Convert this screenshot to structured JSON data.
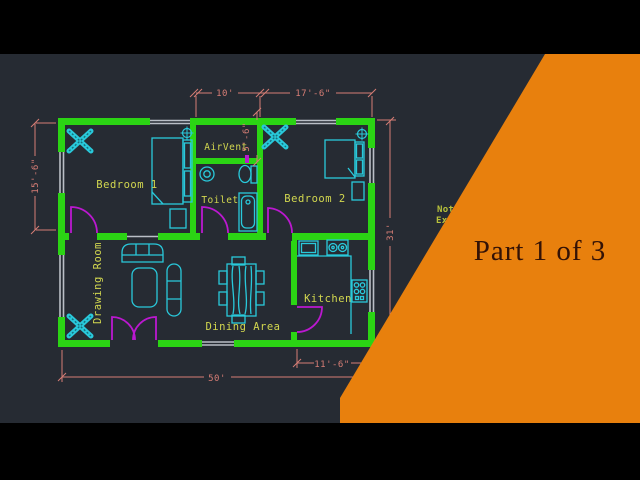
{
  "overlay": {
    "title": "Part 1 of 3",
    "note_line1": "Not",
    "note_line2": "Ex",
    "banner_color": "#e8800d",
    "title_color": "#331206"
  },
  "floor_plan": {
    "room_labels": {
      "bedroom1": "Bedroom 1",
      "bedroom2": "Bedroom 2",
      "airvent": "AirVent",
      "toilet": "Toilet",
      "drawing_room": "Drawing Room",
      "dining_area": "Dining Area",
      "kitchen": "Kitchen"
    },
    "dimensions": {
      "airvent_width": "10'",
      "bedroom2_width": "17'-6\"",
      "bedroom1_height": "15'-6\"",
      "airvent_height": "5'-6\"",
      "plan_height": "31'",
      "plan_width": "50'",
      "kitchen_width": "11'-6\""
    },
    "colors": {
      "background": "#262b33",
      "wall_green": "#2bd414",
      "furniture_cyan": "#29c9db",
      "door_magenta": "#bb18d0",
      "dimension_salmon": "#d67d75",
      "label_yellow": "#d2d74f",
      "window_gray": "#b9bec6"
    }
  }
}
